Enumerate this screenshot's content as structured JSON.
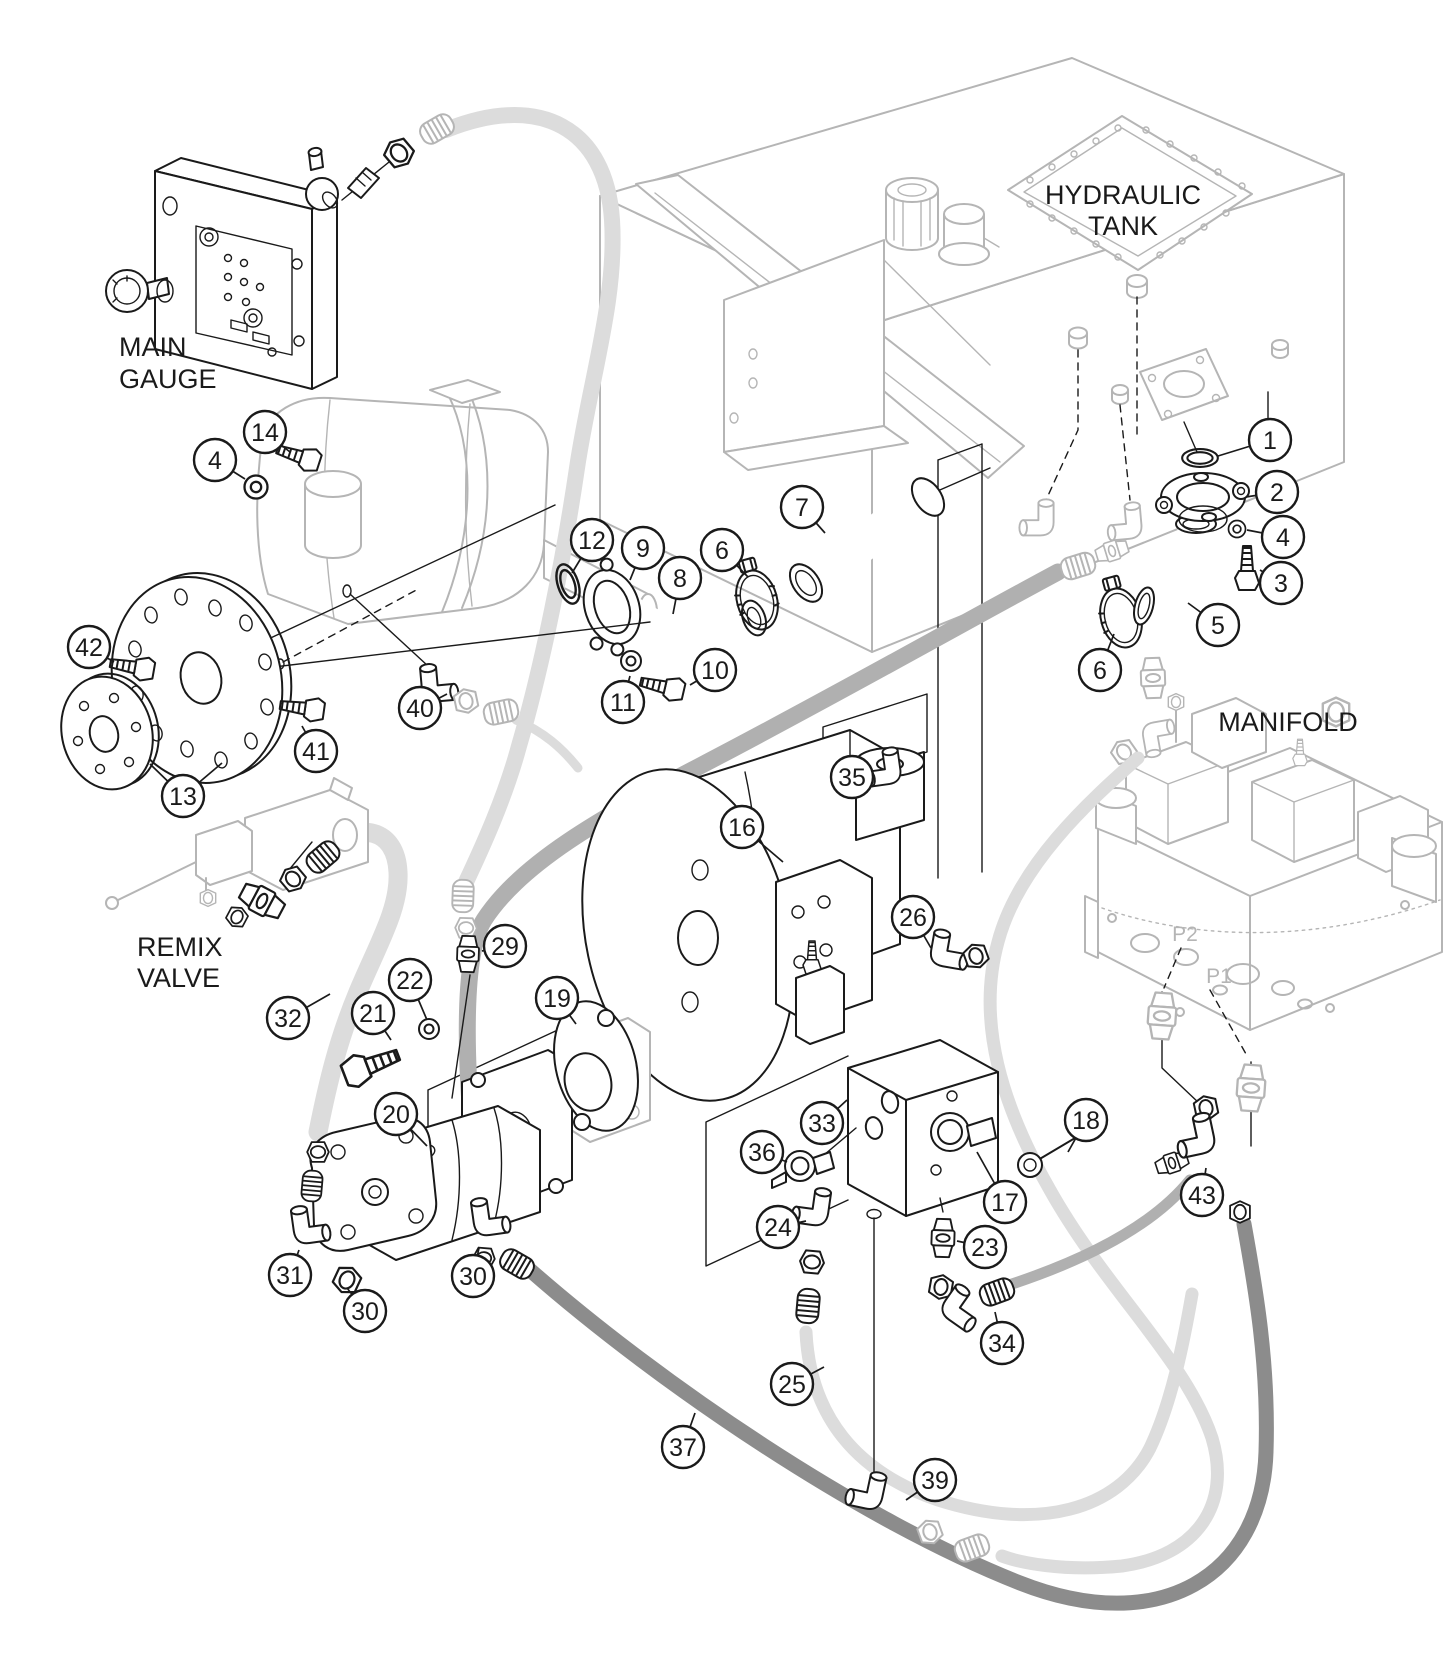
{
  "diagram": {
    "labels": [
      {
        "id": "main-gauge",
        "lines": [
          "MAIN",
          "GAUGE"
        ],
        "x": 119,
        "y": 356,
        "size": 27,
        "anchor": "start",
        "color": "#1a1a1a",
        "line_height": 32
      },
      {
        "id": "hydraulic-tank",
        "lines": [
          "HYDRAULIC",
          "TANK"
        ],
        "x": 1123,
        "y": 204,
        "size": 27,
        "anchor": "middle",
        "color": "#1a1a1a",
        "line_height": 31
      },
      {
        "id": "remix-valve",
        "lines": [
          "REMIX",
          "VALVE"
        ],
        "x": 137,
        "y": 956,
        "size": 27,
        "anchor": "start",
        "color": "#1a1a1a",
        "line_height": 31
      },
      {
        "id": "manifold",
        "lines": [
          "MANIFOLD"
        ],
        "x": 1288,
        "y": 731,
        "size": 27,
        "anchor": "middle",
        "color": "#1a1a1a",
        "line_height": 31
      },
      {
        "id": "port-p2",
        "lines": [
          "P2"
        ],
        "x": 1185,
        "y": 941,
        "size": 21,
        "anchor": "middle",
        "color": "#b5b5b5",
        "line_height": 22
      },
      {
        "id": "port-p1",
        "lines": [
          "P1"
        ],
        "x": 1219,
        "y": 983,
        "size": 21,
        "anchor": "middle",
        "color": "#b5b5b5",
        "line_height": 22
      }
    ],
    "balloon": {
      "radius": 21,
      "font_size": 25
    },
    "callouts": [
      {
        "id": "1",
        "n": "1",
        "x": 1270,
        "y": 440,
        "targets": [
          [
            1218,
            456
          ]
        ]
      },
      {
        "id": "2",
        "n": "2",
        "x": 1277,
        "y": 492,
        "targets": [
          [
            1246,
            497
          ]
        ]
      },
      {
        "id": "3",
        "n": "3",
        "x": 1281,
        "y": 583,
        "targets": [
          [
            1260,
            570
          ]
        ]
      },
      {
        "id": "4a",
        "n": "4",
        "x": 215,
        "y": 460,
        "targets": [
          [
            245,
            479
          ]
        ]
      },
      {
        "id": "4b",
        "n": "4",
        "x": 1283,
        "y": 537,
        "targets": [
          [
            1247,
            530
          ]
        ]
      },
      {
        "id": "5",
        "n": "5",
        "x": 1218,
        "y": 625,
        "targets": [
          [
            1188,
            603
          ]
        ]
      },
      {
        "id": "6a",
        "n": "6",
        "x": 722,
        "y": 550,
        "targets": [
          [
            748,
            577
          ]
        ]
      },
      {
        "id": "6b",
        "n": "6",
        "x": 1100,
        "y": 670,
        "targets": [
          [
            1114,
            634
          ]
        ]
      },
      {
        "id": "7",
        "n": "7",
        "x": 802,
        "y": 507,
        "targets": [
          [
            825,
            533
          ]
        ]
      },
      {
        "id": "8",
        "n": "8",
        "x": 680,
        "y": 578,
        "targets": [
          [
            673,
            614
          ]
        ]
      },
      {
        "id": "9",
        "n": "9",
        "x": 643,
        "y": 548,
        "targets": [
          [
            630,
            580
          ]
        ]
      },
      {
        "id": "10",
        "n": "10",
        "x": 715,
        "y": 670,
        "targets": [
          [
            690,
            685
          ]
        ]
      },
      {
        "id": "11",
        "n": "11",
        "x": 623,
        "y": 702,
        "targets": [
          [
            630,
            676
          ]
        ]
      },
      {
        "id": "12",
        "n": "12",
        "x": 592,
        "y": 540,
        "targets": [
          [
            572,
            573
          ]
        ]
      },
      {
        "id": "13",
        "n": "13",
        "x": 183,
        "y": 796,
        "targets": [
          [
            150,
            764
          ],
          [
            222,
            763
          ]
        ]
      },
      {
        "id": "14",
        "n": "14",
        "x": 265,
        "y": 432,
        "targets": [
          [
            290,
            452
          ]
        ]
      },
      {
        "id": "16",
        "n": "16",
        "x": 742,
        "y": 827,
        "targets": [
          [
            783,
            862
          ]
        ]
      },
      {
        "id": "17",
        "n": "17",
        "x": 1005,
        "y": 1202,
        "targets": [
          [
            977,
            1152
          ]
        ]
      },
      {
        "id": "18",
        "n": "18",
        "x": 1086,
        "y": 1120,
        "targets": [
          [
            1068,
            1152
          ]
        ]
      },
      {
        "id": "19",
        "n": "19",
        "x": 557,
        "y": 998,
        "targets": [
          [
            576,
            1024
          ]
        ]
      },
      {
        "id": "20",
        "n": "20",
        "x": 396,
        "y": 1114,
        "targets": [
          [
            427,
            1146
          ]
        ]
      },
      {
        "id": "21",
        "n": "21",
        "x": 373,
        "y": 1013,
        "targets": [
          [
            391,
            1040
          ]
        ]
      },
      {
        "id": "22",
        "n": "22",
        "x": 410,
        "y": 980,
        "targets": [
          [
            427,
            1020
          ]
        ]
      },
      {
        "id": "23",
        "n": "23",
        "x": 985,
        "y": 1247,
        "targets": [
          [
            957,
            1241
          ]
        ]
      },
      {
        "id": "24",
        "n": "24",
        "x": 778,
        "y": 1227,
        "targets": [
          [
            806,
            1221
          ]
        ]
      },
      {
        "id": "25",
        "n": "25",
        "x": 792,
        "y": 1384,
        "targets": [
          [
            824,
            1367
          ]
        ]
      },
      {
        "id": "26",
        "n": "26",
        "x": 913,
        "y": 917,
        "targets": [
          [
            931,
            948
          ]
        ]
      },
      {
        "id": "29",
        "n": "29",
        "x": 505,
        "y": 946,
        "targets": [
          [
            482,
            951
          ]
        ]
      },
      {
        "id": "30a",
        "n": "30",
        "x": 365,
        "y": 1311,
        "targets": [
          [
            347,
            1288
          ]
        ]
      },
      {
        "id": "30b",
        "n": "30",
        "x": 473,
        "y": 1276,
        "targets": [
          [
            479,
            1248
          ]
        ]
      },
      {
        "id": "31",
        "n": "31",
        "x": 290,
        "y": 1275,
        "targets": [
          [
            299,
            1250
          ]
        ]
      },
      {
        "id": "32",
        "n": "32",
        "x": 288,
        "y": 1018,
        "targets": [
          [
            330,
            994
          ]
        ]
      },
      {
        "id": "33",
        "n": "33",
        "x": 822,
        "y": 1123,
        "targets": [
          [
            847,
            1100
          ]
        ]
      },
      {
        "id": "34",
        "n": "34",
        "x": 1002,
        "y": 1343,
        "targets": [
          [
            995,
            1312
          ]
        ]
      },
      {
        "id": "35",
        "n": "35",
        "x": 852,
        "y": 777,
        "targets": [
          [
            872,
            775
          ]
        ]
      },
      {
        "id": "36",
        "n": "36",
        "x": 762,
        "y": 1152,
        "targets": [
          [
            787,
            1162
          ]
        ]
      },
      {
        "id": "37",
        "n": "37",
        "x": 683,
        "y": 1447,
        "targets": [
          [
            695,
            1413
          ]
        ]
      },
      {
        "id": "39",
        "n": "39",
        "x": 935,
        "y": 1480,
        "targets": [
          [
            906,
            1500
          ]
        ]
      },
      {
        "id": "40",
        "n": "40",
        "x": 420,
        "y": 708,
        "targets": [
          [
            447,
            694
          ]
        ]
      },
      {
        "id": "41",
        "n": "41",
        "x": 316,
        "y": 751,
        "targets": [
          [
            302,
            726
          ]
        ]
      },
      {
        "id": "42",
        "n": "42",
        "x": 89,
        "y": 647,
        "targets": [
          [
            114,
            662
          ]
        ]
      },
      {
        "id": "43",
        "n": "43",
        "x": 1202,
        "y": 1195,
        "targets": [
          [
            1206,
            1168
          ]
        ]
      }
    ]
  },
  "colors": {
    "line": "#1a1a1a",
    "ghost": "#b5b5b5",
    "hose_light": "#dcdcdc",
    "hose_medium": "#b0b0b0",
    "hose_dark": "#8c8c8c",
    "bg": "#ffffff",
    "balloon_fill": "#ffffff"
  }
}
